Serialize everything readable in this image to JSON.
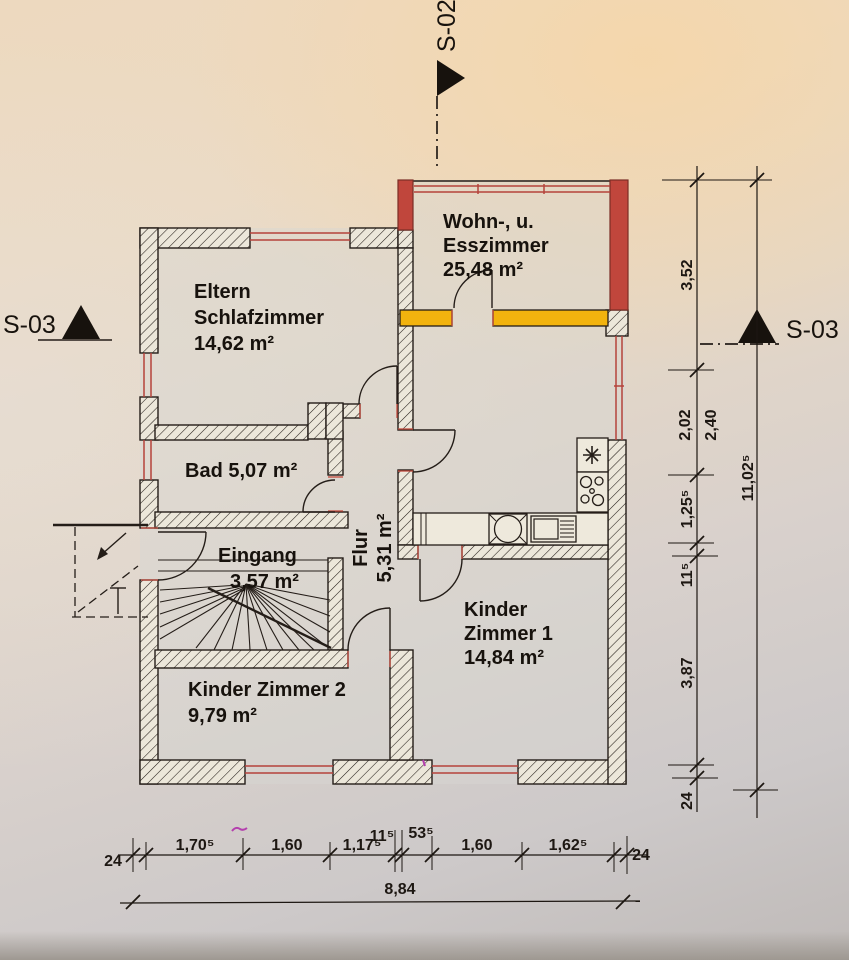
{
  "title": "Wohnung Grundriss (floor plan scan)",
  "colors": {
    "red_wall": "#c0463c",
    "orange_wall": "#f2b30e",
    "window_red": "#b5433b",
    "line": "#241d18",
    "pen_mark": "#b43fae"
  },
  "section_markers": {
    "top": "S-02",
    "left": "S-03",
    "right": "S-03"
  },
  "rooms": {
    "wohnzimmer": {
      "line1": "Wohn-, u.",
      "line2": "Esszimmer",
      "area": "25,48 m²"
    },
    "schlafzimmer": {
      "line1": "Eltern",
      "line2": "Schlafzimmer",
      "area": "14,62 m²"
    },
    "bad": {
      "label": "Bad 5,07 m²"
    },
    "eingang": {
      "line1": "Eingang",
      "line2": "3,57 m²"
    },
    "flur": {
      "line1": "Flur",
      "line2": "5,31 m²"
    },
    "kinderzimmer1": {
      "line1": "Kinder",
      "line2": "Zimmer 1",
      "area": "14,84 m²"
    },
    "kinderzimmer2": {
      "line1": "Kinder Zimmer 2",
      "area": "9,79 m²"
    }
  },
  "dimensions": {
    "right_chain": {
      "d1": "3,52",
      "d2": "2,02",
      "d2b": "2,40",
      "d3": "1,25⁵",
      "d4": "11⁵",
      "d5": "3,87",
      "d6": "24"
    },
    "right_total": "11,02⁵",
    "bottom_chain": {
      "d1": "24",
      "d2": "1,70⁵",
      "d3": "1,60",
      "d4": "1,17⁵",
      "d5": "11⁵",
      "d6": "53⁵",
      "d7": "1,60",
      "d8": "1,62⁵",
      "d9": "24"
    },
    "bottom_total": "8,84"
  }
}
